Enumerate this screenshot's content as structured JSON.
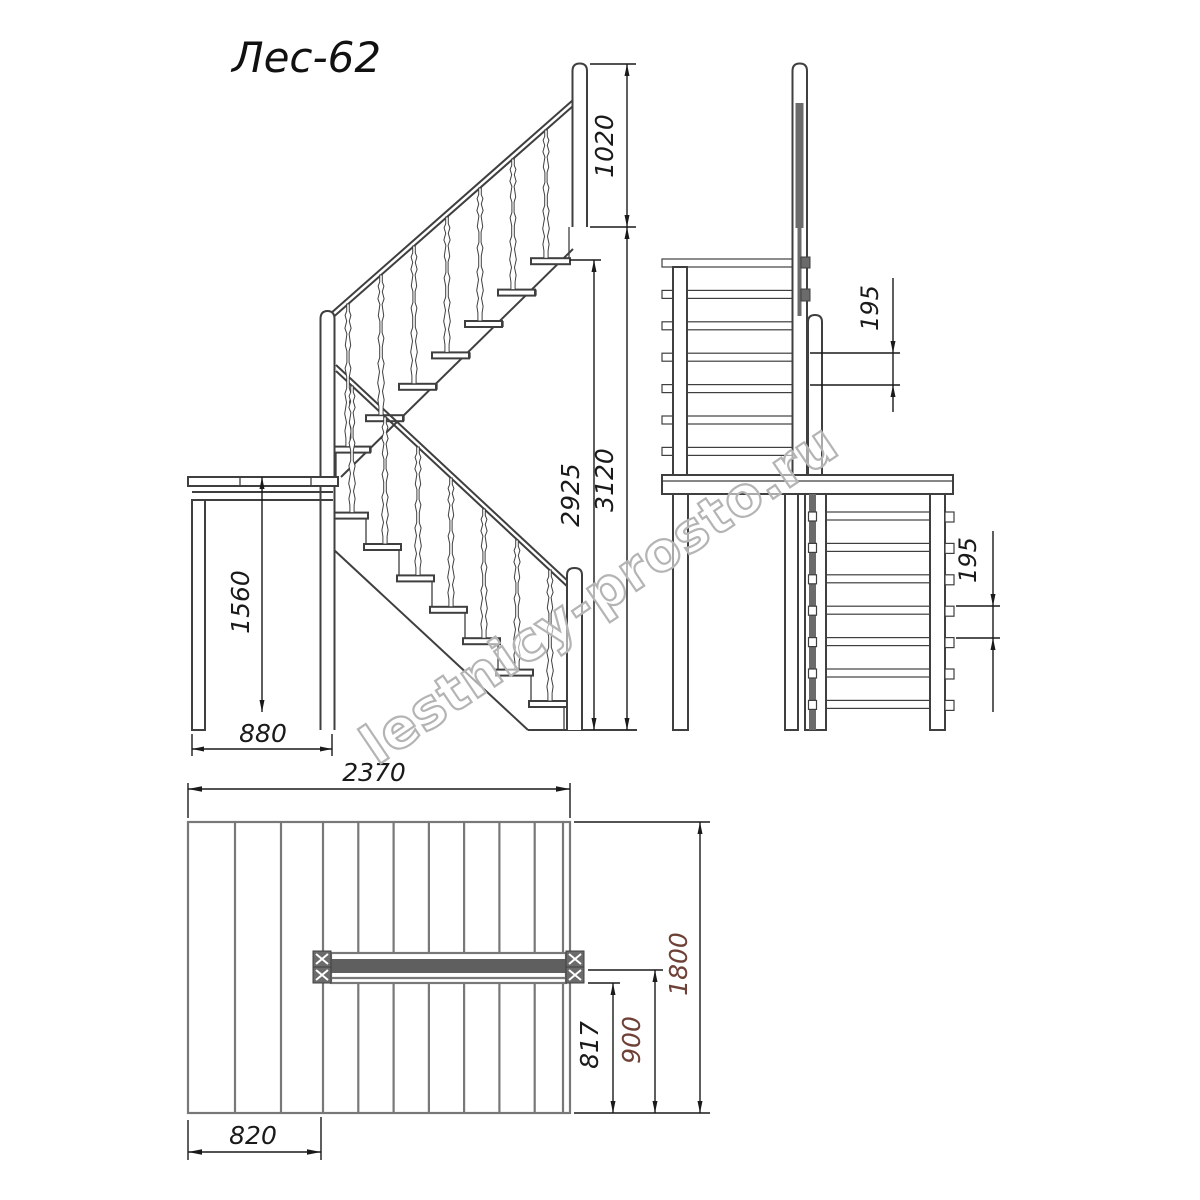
{
  "title": "Лес-62",
  "watermark": "lestnicy-prosto.ru",
  "colors": {
    "drawing_line": "#3f3f3f",
    "plan_line": "#787878",
    "dark_fill": "#6b6b6b",
    "dimension": "#1a1a1a",
    "accent_dim": "#6e4036",
    "watermark": "#b4b4b4",
    "background": "#ffffff"
  },
  "side_view": {
    "name": "side elevation of staircase",
    "newel_height_above_floor": "1020",
    "rise_to_top_tread": "2925",
    "total_rise": "3120",
    "platform_height": "1560",
    "platform_depth": "880"
  },
  "front_view": {
    "name": "front elevation of staircase",
    "riser_step_upper": "195",
    "riser_step_lower": "195"
  },
  "plan_view": {
    "name": "plan view of staircase",
    "total_length": "2370",
    "total_width": "1800",
    "flight_width": "900",
    "clear_width": "817",
    "landing_depth": "820"
  }
}
